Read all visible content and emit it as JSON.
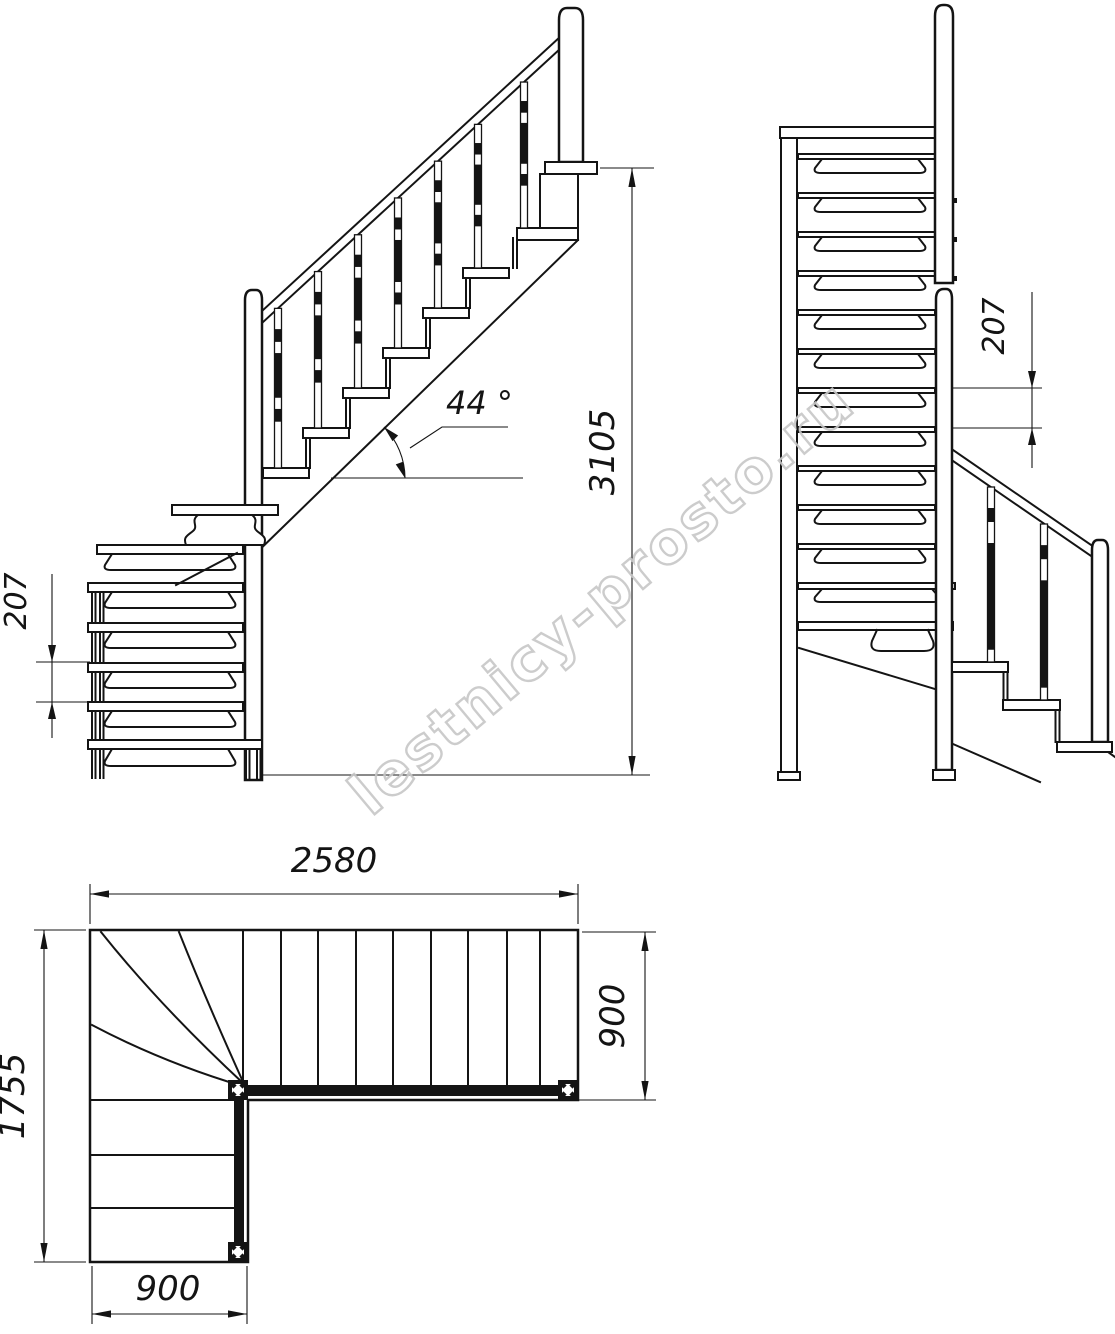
{
  "drawing": {
    "type": "staircase-technical-drawing",
    "views": [
      "front-elevation",
      "side-elevation",
      "plan"
    ]
  },
  "dims": {
    "left_riser": "207",
    "left_angle": "44 °",
    "left_height": "3105",
    "right_riser": "207",
    "plan_length": "2580",
    "plan_top_width": "900",
    "plan_depth": "1755",
    "plan_bottom_width": "900"
  },
  "watermark": {
    "text": "lestnicy-prosto.ru"
  }
}
